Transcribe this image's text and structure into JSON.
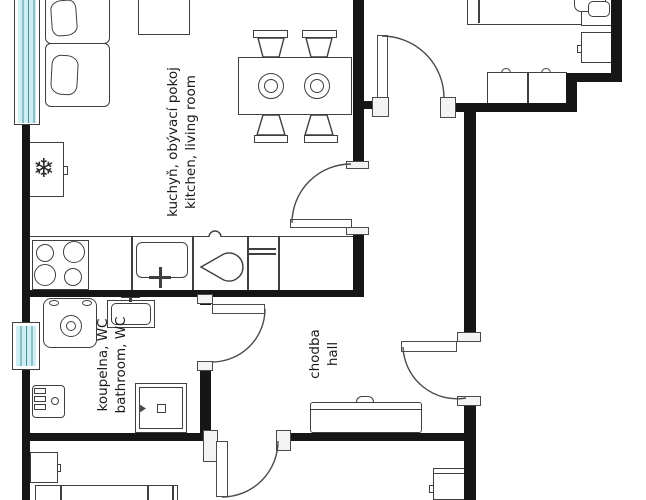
{
  "title": "apartment floor plan",
  "labels": {
    "kitchen_living": {
      "cs": "kuchyň, obývací pokoj",
      "en": "kitchen, living room"
    },
    "bathroom": {
      "cs": "koupelna, WC",
      "en": "bathroom, WC"
    },
    "hall": {
      "cs": "chodba",
      "en": "hall"
    }
  },
  "icons": {
    "snowflake": "❄"
  },
  "colors": {
    "wall": "#161616",
    "furniture_outline": "#3f3f3f",
    "door_outline": "#4a4a4a",
    "window_fill": "#cdeef3",
    "window_stripe": "#4f8e99",
    "background": "#ffffff",
    "text": "#1a1a1a"
  }
}
